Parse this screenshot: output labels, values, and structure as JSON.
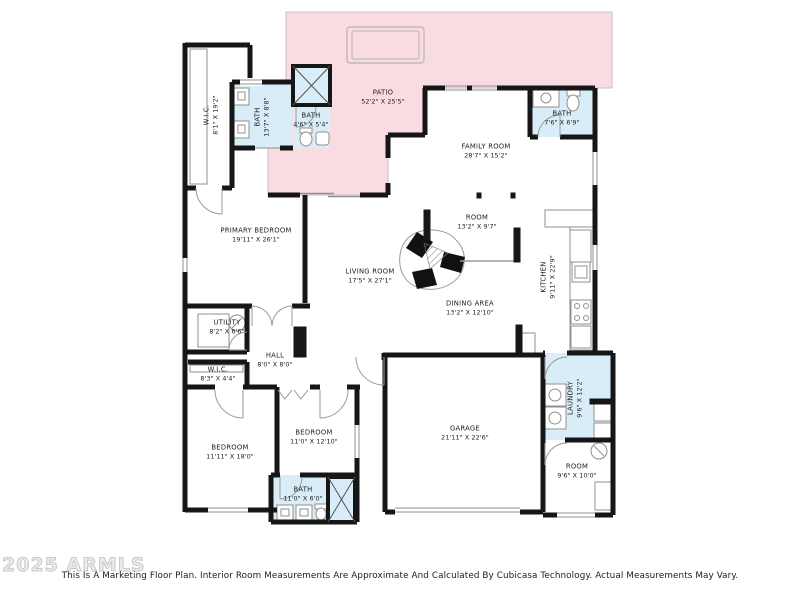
{
  "title": "Marketing Floor Plan",
  "colors": {
    "patio": "#f9dce2",
    "wet_room": "#d9edf8",
    "wall": "#161616",
    "thin_line": "#9a9a9a",
    "label_text": "#1c1c1c",
    "watermark": "#cccccc"
  },
  "rooms": [
    {
      "name": "PATIO",
      "dims": "52'2\" X 25'5\"",
      "orientation": "horizontal"
    },
    {
      "name": "W.I.C.",
      "dims": "8'1\" X 19'2\"",
      "orientation": "vertical"
    },
    {
      "name": "BATH",
      "dims": "13'7\" X 8'8\"",
      "orientation": "vertical"
    },
    {
      "name": "BATH",
      "dims": "4'6\" X 5'4\"",
      "orientation": "horizontal"
    },
    {
      "name": "BATH",
      "dims": "7'6\" X 6'9\"",
      "orientation": "horizontal"
    },
    {
      "name": "FAMILY ROOM",
      "dims": "28'7\" X 15'2\"",
      "orientation": "horizontal"
    },
    {
      "name": "PRIMARY BEDROOM",
      "dims": "19'11\" X 26'1\"",
      "orientation": "horizontal"
    },
    {
      "name": "LIVING ROOM",
      "dims": "17'5\" X 27'1\"",
      "orientation": "horizontal"
    },
    {
      "name": "ROOM",
      "dims": "13'2\" X 9'7\"",
      "orientation": "horizontal"
    },
    {
      "name": "DINING AREA",
      "dims": "13'2\" X 12'10\"",
      "orientation": "horizontal"
    },
    {
      "name": "KITCHEN",
      "dims": "9'11\" X 22'9\"",
      "orientation": "vertical"
    },
    {
      "name": "UTILITY",
      "dims": "8'2\" X 6'6\"",
      "orientation": "horizontal"
    },
    {
      "name": "HALL",
      "dims": "8'0\" X 8'0\"",
      "orientation": "horizontal"
    },
    {
      "name": "W.I.C.",
      "dims": "8'3\" X 4'4\"",
      "orientation": "horizontal"
    },
    {
      "name": "BEDROOM",
      "dims": "11'11\" X 18'0\"",
      "orientation": "horizontal"
    },
    {
      "name": "BEDROOM",
      "dims": "11'0\" X 12'10\"",
      "orientation": "horizontal"
    },
    {
      "name": "BATH",
      "dims": "11'0\" X 6'0\"",
      "orientation": "horizontal"
    },
    {
      "name": "GARAGE",
      "dims": "21'11\" X 22'6\"",
      "orientation": "horizontal"
    },
    {
      "name": "LAUNDRY",
      "dims": "9'6\" X 12'2\"",
      "orientation": "vertical"
    },
    {
      "name": "ROOM",
      "dims": "9'6\" X 10'0\"",
      "orientation": "horizontal"
    }
  ],
  "footer": {
    "watermark": "2025 ARMLS",
    "disclaimer": "This Is A Marketing Floor Plan. Interior Room Measurements Are Approximate And Calculated By Cubicasa Technology. Actual Measurements May Vary."
  }
}
